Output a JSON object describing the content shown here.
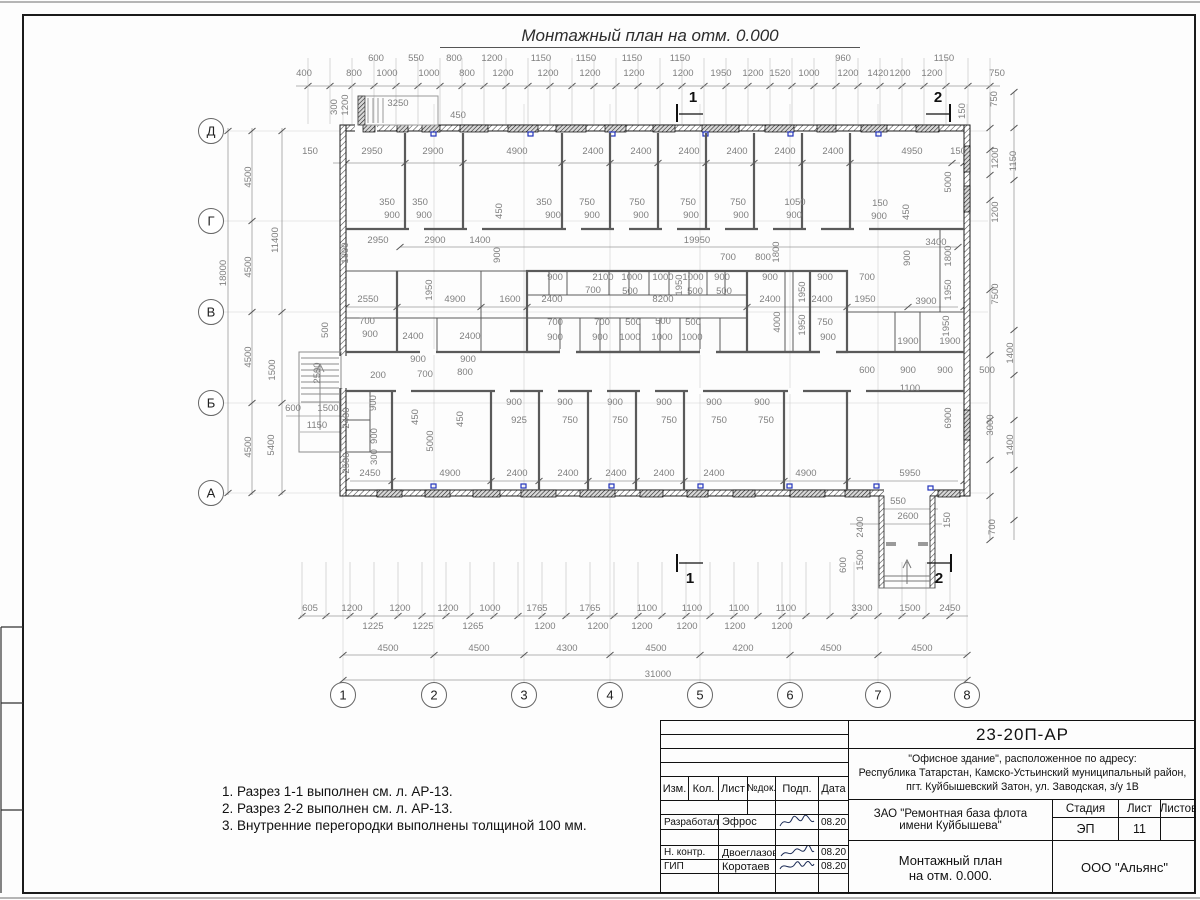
{
  "sheet": {
    "title": "Монтажный план на отм. 0.000"
  },
  "notes": {
    "items": [
      "1. Разрез 1-1 выполнен см. л. АР-13.",
      "2. Разрез 2-2 выполнен см. л. АР-13.",
      "3. Внутренние перегородки выполнены толщиной 100 мм."
    ]
  },
  "title_block": {
    "doc_number": "23-20П-АР",
    "address": [
      "\"Офисное здание\", расположенное по адресу:",
      "Республика Татарстан, Камско-Устьинский муниципальный район,",
      "пгт. Куйбышевский Затон, ул. Заводская, з/у 1В"
    ],
    "client_line1": "ЗАО \"Ремонтная база флота",
    "client_line2": "имени Куйбышева\"",
    "sheet_title_line1": "Монтажный план",
    "sheet_title_line2": "на отм. 0.000.",
    "company": "ООО \"Альянс\"",
    "stage_label": "Стадия",
    "sheet_label": "Лист",
    "sheets_label": "Листов",
    "stage_value": "ЭП",
    "sheet_value": "11",
    "columns": [
      "Изм.",
      "Кол.",
      "Лист",
      "№док.",
      "Подп.",
      "Дата"
    ],
    "rows": [
      {
        "role": "Разработал",
        "name": "Эфрос",
        "date": "08.20"
      },
      {
        "role": "Н. контр.",
        "name": "Двоеглазов",
        "date": "08.20"
      },
      {
        "role": "ГИП",
        "name": "Коротаев",
        "date": "08.20"
      }
    ]
  },
  "plan": {
    "axis_letters": [
      [
        "Д",
        131
      ],
      [
        "Г",
        221
      ],
      [
        "В",
        312
      ],
      [
        "Б",
        403
      ],
      [
        "А",
        493
      ]
    ],
    "axis_numbers": [
      [
        "1",
        343
      ],
      [
        "2",
        434
      ],
      [
        "3",
        524
      ],
      [
        "4",
        610
      ],
      [
        "5",
        700
      ],
      [
        "6",
        790
      ],
      [
        "7",
        878
      ],
      [
        "8",
        967
      ]
    ],
    "sections": [
      [
        "1",
        693,
        102
      ],
      [
        "2",
        938,
        102
      ],
      [
        "1",
        690,
        583
      ],
      [
        "2",
        939,
        583
      ]
    ],
    "labels": [
      [
        376,
        61,
        "600"
      ],
      [
        416,
        61,
        "550"
      ],
      [
        454,
        61,
        "800"
      ],
      [
        492,
        61,
        "1200"
      ],
      [
        541,
        61,
        "1150"
      ],
      [
        586,
        61,
        "1150"
      ],
      [
        632,
        61,
        "1150"
      ],
      [
        680,
        61,
        "1150"
      ],
      [
        843,
        61,
        "960"
      ],
      [
        944,
        61,
        "1150"
      ],
      [
        304,
        76,
        "400"
      ],
      [
        354,
        76,
        "800"
      ],
      [
        387,
        76,
        "1000"
      ],
      [
        429,
        76,
        "1000"
      ],
      [
        467,
        76,
        "800"
      ],
      [
        503,
        76,
        "1200"
      ],
      [
        548,
        76,
        "1200"
      ],
      [
        590,
        76,
        "1200"
      ],
      [
        634,
        76,
        "1200"
      ],
      [
        683,
        76,
        "1200"
      ],
      [
        721,
        76,
        "1950"
      ],
      [
        753,
        76,
        "1200"
      ],
      [
        780,
        76,
        "1520"
      ],
      [
        809,
        76,
        "1000"
      ],
      [
        848,
        76,
        "1200"
      ],
      [
        878,
        76,
        "1420"
      ],
      [
        900,
        76,
        "1200"
      ],
      [
        932,
        76,
        "1200"
      ],
      [
        997,
        76,
        "750"
      ],
      [
        398,
        106,
        "3250"
      ],
      [
        458,
        118,
        "450"
      ],
      [
        337,
        107,
        "300",
        1
      ],
      [
        348,
        105,
        "1200",
        1
      ],
      [
        310,
        154,
        "150"
      ],
      [
        372,
        154,
        "2950"
      ],
      [
        433,
        154,
        "2900"
      ],
      [
        517,
        154,
        "4900"
      ],
      [
        593,
        154,
        "2400"
      ],
      [
        641,
        154,
        "2400"
      ],
      [
        689,
        154,
        "2400"
      ],
      [
        737,
        154,
        "2400"
      ],
      [
        785,
        154,
        "2400"
      ],
      [
        833,
        154,
        "2400"
      ],
      [
        912,
        154,
        "4950"
      ],
      [
        958,
        154,
        "150"
      ],
      [
        387,
        205,
        "350"
      ],
      [
        420,
        205,
        "350"
      ],
      [
        544,
        205,
        "350"
      ],
      [
        587,
        205,
        "750"
      ],
      [
        637,
        205,
        "750"
      ],
      [
        688,
        205,
        "750"
      ],
      [
        738,
        205,
        "750"
      ],
      [
        795,
        205,
        "1050"
      ],
      [
        880,
        206,
        "150"
      ],
      [
        392,
        218,
        "900"
      ],
      [
        424,
        218,
        "900"
      ],
      [
        553,
        218,
        "900"
      ],
      [
        592,
        218,
        "900"
      ],
      [
        641,
        218,
        "900"
      ],
      [
        691,
        218,
        "900"
      ],
      [
        741,
        218,
        "900"
      ],
      [
        794,
        218,
        "900"
      ],
      [
        879,
        219,
        "900"
      ],
      [
        502,
        211,
        "450",
        1
      ],
      [
        909,
        212,
        "450",
        1
      ],
      [
        378,
        243,
        "2950"
      ],
      [
        435,
        243,
        "2900"
      ],
      [
        480,
        243,
        "1400"
      ],
      [
        697,
        243,
        "19950"
      ],
      [
        936,
        245,
        "3400"
      ],
      [
        500,
        255,
        "900",
        1
      ],
      [
        348,
        253,
        "1800",
        1
      ],
      [
        779,
        252,
        "1800",
        1
      ],
      [
        951,
        256,
        "1800",
        1
      ],
      [
        910,
        258,
        "900",
        1
      ],
      [
        728,
        260,
        "700"
      ],
      [
        763,
        260,
        "800"
      ],
      [
        555,
        280,
        "900"
      ],
      [
        603,
        280,
        "2100"
      ],
      [
        632,
        280,
        "1000"
      ],
      [
        663,
        280,
        "1000"
      ],
      [
        693,
        280,
        "1000"
      ],
      [
        722,
        280,
        "900"
      ],
      [
        770,
        280,
        "900"
      ],
      [
        825,
        280,
        "900"
      ],
      [
        867,
        280,
        "700"
      ],
      [
        593,
        293,
        "700"
      ],
      [
        630,
        294,
        "500"
      ],
      [
        695,
        294,
        "500"
      ],
      [
        724,
        294,
        "500"
      ],
      [
        682,
        285,
        "1950",
        1
      ],
      [
        805,
        292,
        "1950",
        1
      ],
      [
        951,
        290,
        "1950",
        1
      ],
      [
        432,
        290,
        "1950",
        1
      ],
      [
        368,
        302,
        "2550"
      ],
      [
        455,
        302,
        "4900"
      ],
      [
        510,
        302,
        "1600"
      ],
      [
        552,
        302,
        "2400"
      ],
      [
        663,
        302,
        "8200"
      ],
      [
        770,
        302,
        "2400"
      ],
      [
        822,
        302,
        "2400"
      ],
      [
        865,
        302,
        "1950"
      ],
      [
        926,
        304,
        "3900"
      ],
      [
        555,
        325,
        "700"
      ],
      [
        555,
        340,
        "900"
      ],
      [
        602,
        325,
        "700"
      ],
      [
        600,
        340,
        "900"
      ],
      [
        633,
        325,
        "500"
      ],
      [
        630,
        340,
        "1000"
      ],
      [
        663,
        324,
        "500"
      ],
      [
        662,
        340,
        "1000"
      ],
      [
        693,
        325,
        "500"
      ],
      [
        692,
        340,
        "1000"
      ],
      [
        825,
        325,
        "750"
      ],
      [
        828,
        340,
        "900"
      ],
      [
        805,
        325,
        "1950",
        1
      ],
      [
        780,
        322,
        "4000",
        1
      ],
      [
        367,
        324,
        "700"
      ],
      [
        370,
        337,
        "900"
      ],
      [
        413,
        339,
        "2400"
      ],
      [
        470,
        339,
        "2400"
      ],
      [
        418,
        362,
        "900"
      ],
      [
        468,
        362,
        "900"
      ],
      [
        425,
        377,
        "700"
      ],
      [
        465,
        375,
        "800"
      ],
      [
        378,
        378,
        "200"
      ],
      [
        328,
        330,
        "500",
        1
      ],
      [
        320,
        373,
        "2500",
        1
      ],
      [
        275,
        370,
        "1500",
        1
      ],
      [
        908,
        344,
        "1900"
      ],
      [
        950,
        344,
        "1900"
      ],
      [
        867,
        373,
        "600"
      ],
      [
        908,
        373,
        "900"
      ],
      [
        945,
        373,
        "900"
      ],
      [
        910,
        391,
        "1100"
      ],
      [
        987,
        373,
        "500"
      ],
      [
        951,
        418,
        "6900",
        1
      ],
      [
        910,
        476,
        "5950"
      ],
      [
        949,
        326,
        "1950",
        1
      ],
      [
        898,
        504,
        "550"
      ],
      [
        908,
        519,
        "2600"
      ],
      [
        950,
        520,
        "150",
        1
      ],
      [
        863,
        527,
        "2400",
        1
      ],
      [
        863,
        560,
        "1500",
        1
      ],
      [
        846,
        565,
        "600",
        1
      ],
      [
        997,
        99,
        "750",
        1
      ],
      [
        965,
        111,
        "150",
        1
      ],
      [
        951,
        182,
        "5000",
        1
      ],
      [
        998,
        158,
        "1200",
        1
      ],
      [
        1016,
        161,
        "1150",
        1
      ],
      [
        998,
        212,
        "1200",
        1
      ],
      [
        998,
        294,
        "7500",
        1
      ],
      [
        993,
        425,
        "3000",
        1
      ],
      [
        1013,
        353,
        "1400",
        1
      ],
      [
        1013,
        445,
        "1400",
        1
      ],
      [
        995,
        527,
        "700",
        1
      ],
      [
        226,
        273,
        "18000",
        1
      ],
      [
        251,
        177,
        "4500",
        1
      ],
      [
        251,
        267,
        "4500",
        1
      ],
      [
        251,
        357,
        "4500",
        1
      ],
      [
        251,
        447,
        "4500",
        1
      ],
      [
        278,
        240,
        "11400",
        1
      ],
      [
        274,
        445,
        "5400",
        1
      ],
      [
        293,
        411,
        "600"
      ],
      [
        328,
        411,
        "1500"
      ],
      [
        317,
        428,
        "1150"
      ],
      [
        349,
        418,
        "2400",
        1
      ],
      [
        349,
        463,
        "2500",
        1
      ],
      [
        376,
        403,
        "900",
        1
      ],
      [
        377,
        436,
        "900",
        1
      ],
      [
        377,
        457,
        "300",
        1
      ],
      [
        418,
        417,
        "450",
        1
      ],
      [
        463,
        419,
        "450",
        1
      ],
      [
        433,
        441,
        "5000",
        1
      ],
      [
        370,
        476,
        "2450"
      ],
      [
        450,
        476,
        "4900"
      ],
      [
        517,
        476,
        "2400"
      ],
      [
        568,
        476,
        "2400"
      ],
      [
        616,
        476,
        "2400"
      ],
      [
        664,
        476,
        "2400"
      ],
      [
        714,
        476,
        "2400"
      ],
      [
        806,
        476,
        "4900"
      ],
      [
        514,
        405,
        "900"
      ],
      [
        519,
        423,
        "925"
      ],
      [
        565,
        405,
        "900"
      ],
      [
        570,
        423,
        "750"
      ],
      [
        615,
        405,
        "900"
      ],
      [
        620,
        423,
        "750"
      ],
      [
        664,
        405,
        "900"
      ],
      [
        669,
        423,
        "750"
      ],
      [
        714,
        405,
        "900"
      ],
      [
        719,
        423,
        "750"
      ],
      [
        762,
        405,
        "900"
      ],
      [
        766,
        423,
        "750"
      ],
      [
        310,
        611,
        "605"
      ],
      [
        352,
        611,
        "1200"
      ],
      [
        400,
        611,
        "1200"
      ],
      [
        448,
        611,
        "1200"
      ],
      [
        490,
        611,
        "1000"
      ],
      [
        537,
        611,
        "1765"
      ],
      [
        590,
        611,
        "1765"
      ],
      [
        647,
        611,
        "1100"
      ],
      [
        692,
        611,
        "1100"
      ],
      [
        739,
        611,
        "1100"
      ],
      [
        786,
        611,
        "1100"
      ],
      [
        862,
        611,
        "3300"
      ],
      [
        910,
        611,
        "1500"
      ],
      [
        950,
        611,
        "2450"
      ],
      [
        373,
        629,
        "1225"
      ],
      [
        423,
        629,
        "1225"
      ],
      [
        473,
        629,
        "1265"
      ],
      [
        545,
        629,
        "1200"
      ],
      [
        598,
        629,
        "1200"
      ],
      [
        642,
        629,
        "1200"
      ],
      [
        687,
        629,
        "1200"
      ],
      [
        735,
        629,
        "1200"
      ],
      [
        782,
        629,
        "1200"
      ],
      [
        388,
        651,
        "4500"
      ],
      [
        479,
        651,
        "4500"
      ],
      [
        567,
        651,
        "4300"
      ],
      [
        656,
        651,
        "4500"
      ],
      [
        743,
        651,
        "4200"
      ],
      [
        831,
        651,
        "4500"
      ],
      [
        922,
        651,
        "4500"
      ],
      [
        658,
        677,
        "31000"
      ]
    ]
  }
}
